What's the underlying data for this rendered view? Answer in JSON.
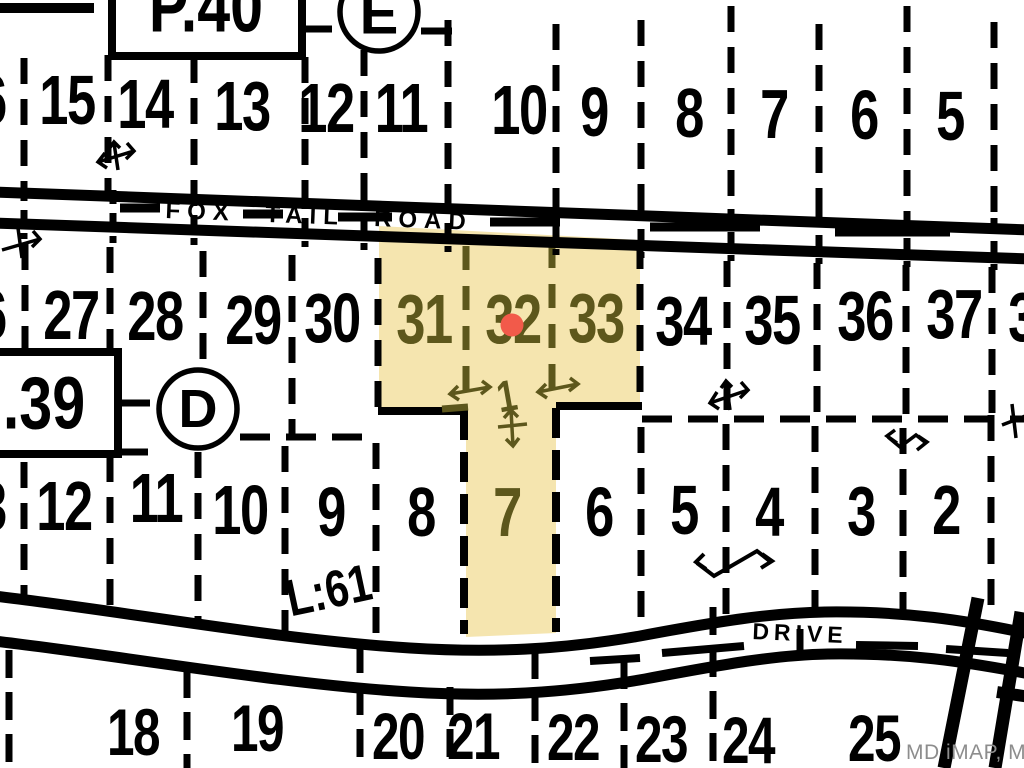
{
  "map": {
    "watermark": "MD iMAP, MDP",
    "colors": {
      "highlight": "#f5e5af",
      "highlight_text": "#5d571c",
      "selected_marker": "#f25a4a",
      "line": "#000000",
      "watermark_text": "#8d8d8d"
    },
    "roads": {
      "top_name": "FOX TAIL ROAD",
      "bottom_name": "DRIVE"
    },
    "annotations": {
      "plat_ref_top": "P.40",
      "plat_ref_left": ".39",
      "block_e": "E",
      "block_d": "D",
      "lot_label": "1",
      "liber_ref": "L:61"
    },
    "rows": {
      "top": [
        "6",
        "15",
        "14",
        "13",
        "12",
        "11",
        "10",
        "9",
        "8",
        "7",
        "6",
        "5"
      ],
      "middle": [
        "6",
        "27",
        "28",
        "29",
        "30",
        "31",
        "32",
        "33",
        "34",
        "35",
        "36",
        "37",
        "3"
      ],
      "lower": [
        "3",
        "12",
        "11",
        "10",
        "9",
        "8",
        "7",
        "6",
        "5",
        "4",
        "3",
        "2"
      ],
      "bottom": [
        "18",
        "19",
        "20",
        "21",
        "22",
        "23",
        "24",
        "25"
      ]
    },
    "highlighted_parcels": [
      "31",
      "32",
      "33",
      "7"
    ],
    "selected_parcel": "32"
  }
}
